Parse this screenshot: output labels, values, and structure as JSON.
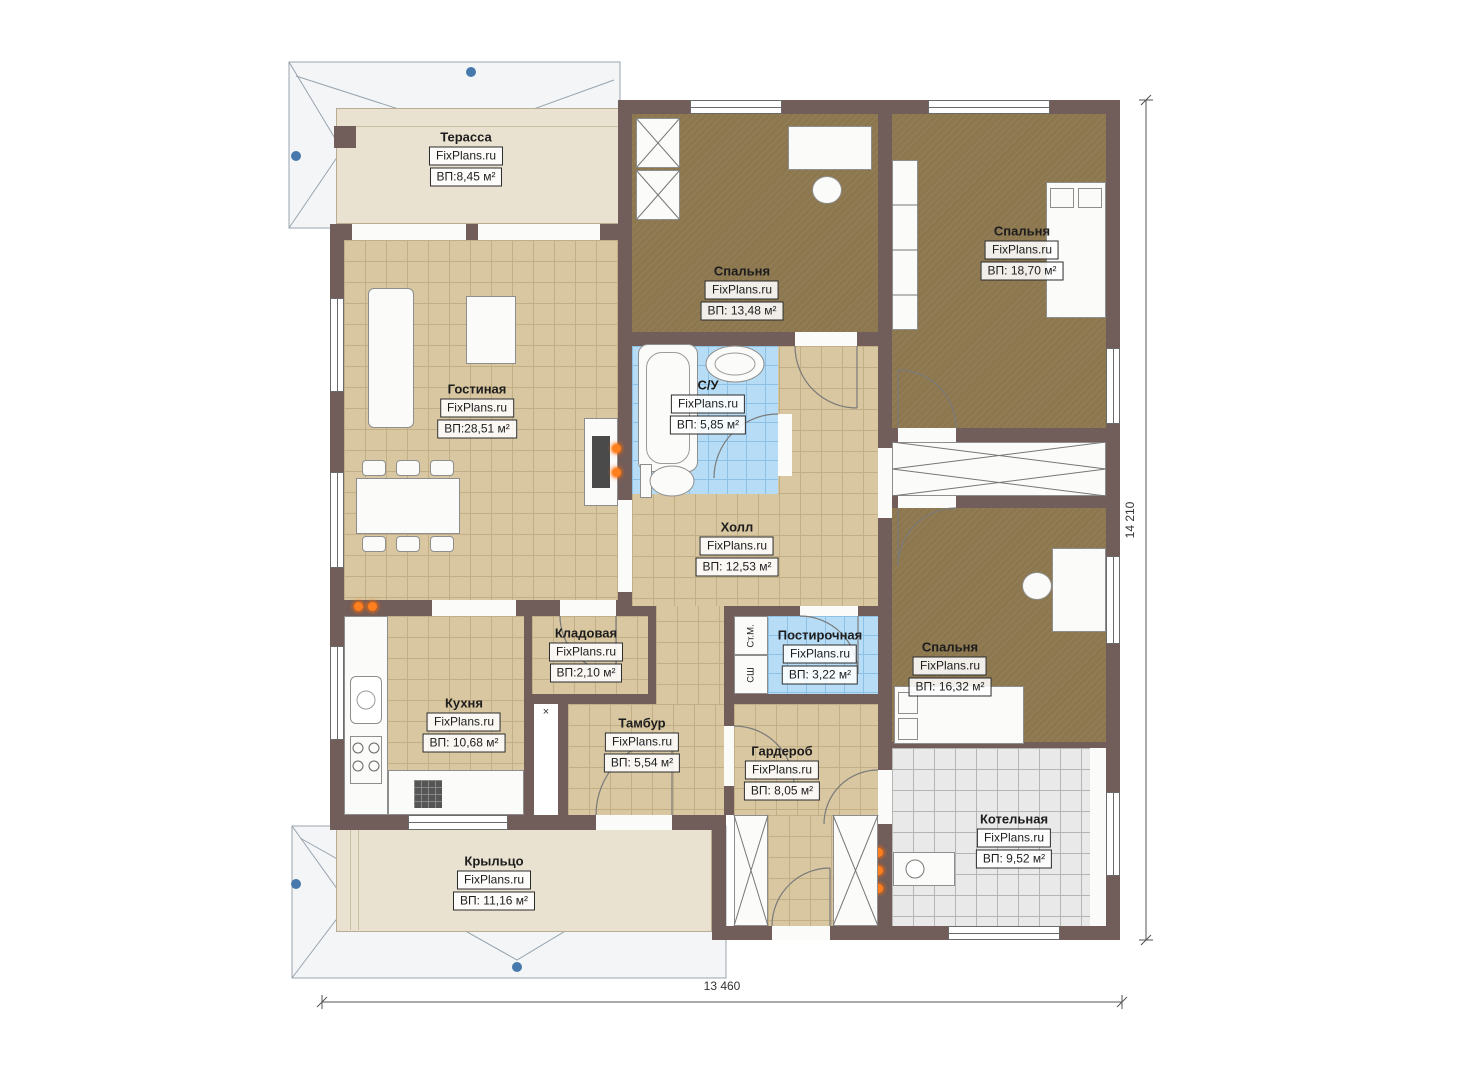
{
  "plan": {
    "rooms": [
      {
        "id": "terrace",
        "name": "Терасса",
        "brand": "FixPlans.ru",
        "area": "ВП:8,45 м²"
      },
      {
        "id": "bedroom1",
        "name": "Спальня",
        "brand": "FixPlans.ru",
        "area": "ВП: 13,48 м²"
      },
      {
        "id": "bedroom2",
        "name": "Спальня",
        "brand": "FixPlans.ru",
        "area": "ВП: 18,70 м²"
      },
      {
        "id": "living",
        "name": "Гостиная",
        "brand": "FixPlans.ru",
        "area": "ВП:28,51 м²"
      },
      {
        "id": "bathroom",
        "name": "С/У",
        "brand": "FixPlans.ru",
        "area": "ВП: 5,85 м²"
      },
      {
        "id": "hall",
        "name": "Холл",
        "brand": "FixPlans.ru",
        "area": "ВП: 12,53 м²"
      },
      {
        "id": "storage",
        "name": "Кладовая",
        "brand": "FixPlans.ru",
        "area": "ВП:2,10 м²"
      },
      {
        "id": "laundry",
        "name": "Постирочная",
        "brand": "FixPlans.ru",
        "area": "ВП: 3,22 м²"
      },
      {
        "id": "bedroom3",
        "name": "Спальня",
        "brand": "FixPlans.ru",
        "area": "ВП: 16,32 м²"
      },
      {
        "id": "kitchen",
        "name": "Кухня",
        "brand": "FixPlans.ru",
        "area": "ВП: 10,68 м²"
      },
      {
        "id": "vestibule",
        "name": "Тамбур",
        "brand": "FixPlans.ru",
        "area": "ВП: 5,54 м²"
      },
      {
        "id": "wardrobe",
        "name": "Гардероб",
        "brand": "FixPlans.ru",
        "area": "ВП: 8,05 м²"
      },
      {
        "id": "boiler",
        "name": "Котельная",
        "brand": "FixPlans.ru",
        "area": "ВП: 9,52 м²"
      },
      {
        "id": "porch",
        "name": "Крыльцо",
        "brand": "FixPlans.ru",
        "area": "ВП: 11,16 м²"
      }
    ],
    "dimensions": {
      "height": "14 210",
      "width": "13 460"
    },
    "appliances": {
      "washer": "Ст.М.",
      "dryer": "СШ"
    },
    "symbols": {
      "vent": "×"
    },
    "palette": {
      "wall": "#715d5a",
      "tile_tan": "#d8c7a1",
      "tile_blue": "#b7dcf5",
      "tile_gray": "#e9e9e9",
      "carpet": "#8c774f",
      "terrace": "#eae2d1",
      "accent_orange": "#ff7f1f",
      "marker_blue": "#4779ad"
    }
  }
}
